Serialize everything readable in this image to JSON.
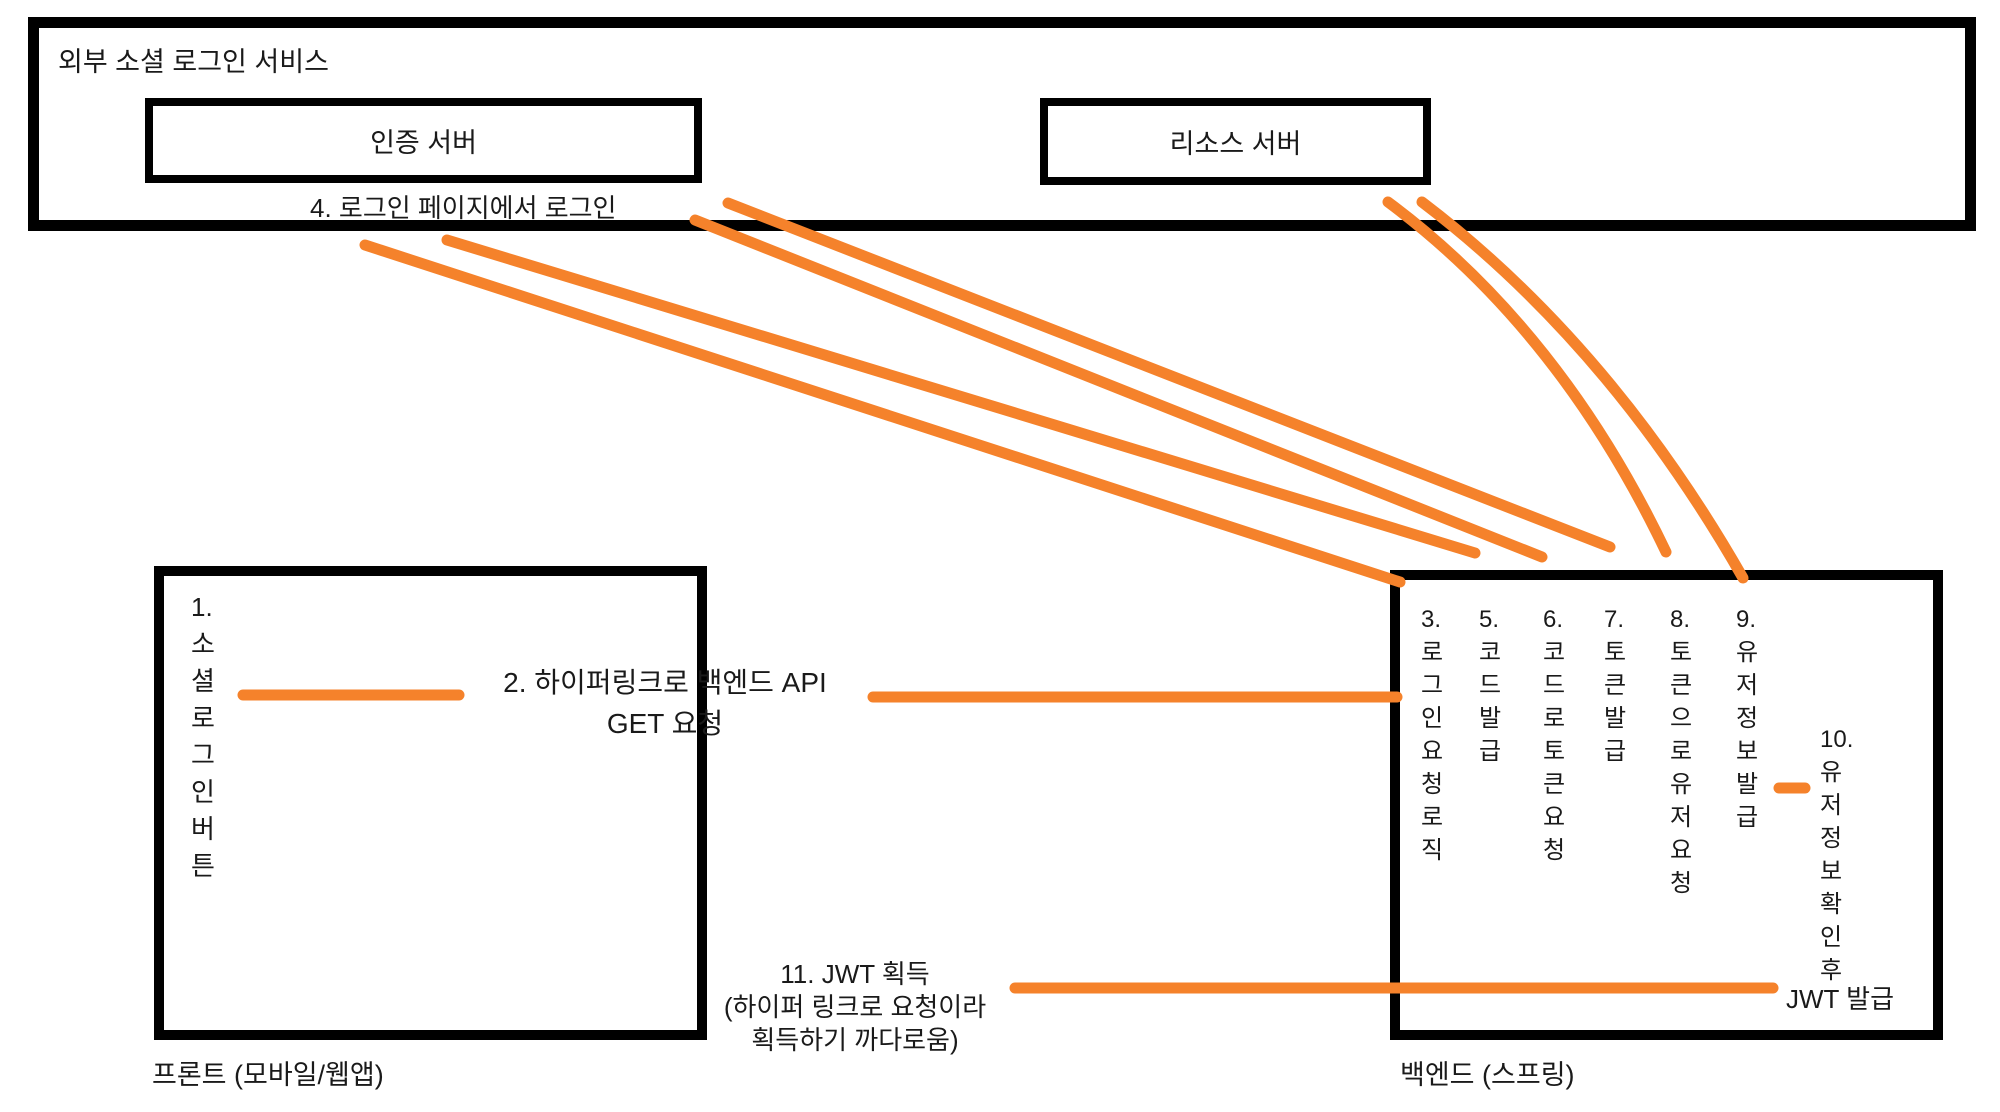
{
  "page": {
    "accent": "#f5822b",
    "stroke": "#000000",
    "background": "#ffffff"
  },
  "external_service": {
    "label": "외부 소셜 로그인 서비스",
    "auth_server_label": "인증 서버",
    "resource_server_label": "리소스 서버",
    "step4_label": "4. 로그인 페이지에서 로그인"
  },
  "frontend": {
    "social_login_button_text": "1.\n소\n셜\n로\n그\n인\n버\n튼",
    "step2_label": "2. 하이퍼링크로 백엔드 API\nGET 요청",
    "box_label": "프론트 (모바일/웹앱)"
  },
  "backend": {
    "columns": [
      "3.\n로\n그\n인\n요\n청\n로\n직",
      "5.\n코\n드\n발\n급",
      "6.\n코\n드\n로\n토\n큰\n요\n청",
      "7.\n토\n큰\n발\n급",
      "8.\n토\n큰\n으\n로\n유\n저\n요\n청",
      "9.\n유\n저\n정\n보\n발\n급"
    ],
    "step10_text": "10.\n유\n저\n정\n보\n확\n인\n후",
    "jwt_issue_label": "JWT 발급",
    "box_label": "백엔드 (스프링)"
  },
  "step11_label": "11. JWT 획득\n(하이퍼 링크로 요청이라\n획득하기 까다로움)",
  "connectors": [
    {
      "name": "button-to-step2-line",
      "x1": 243,
      "y1": 695,
      "x2": 459,
      "y2": 695
    },
    {
      "name": "step2-to-backend-line",
      "x1": 873,
      "y1": 697,
      "x2": 1397,
      "y2": 697
    },
    {
      "name": "login-request-to-auth-line",
      "x1": 365,
      "y1": 245,
      "x2": 1400,
      "y2": 582
    },
    {
      "name": "code-issue-to-backend-line",
      "x1": 447,
      "y1": 240,
      "x2": 1475,
      "y2": 553
    },
    {
      "name": "token-request-to-auth-line",
      "x1": 695,
      "y1": 220,
      "x2": 1542,
      "y2": 557
    },
    {
      "name": "token-issue-to-backend-line",
      "x1": 728,
      "y1": 203,
      "x2": 1610,
      "y2": 547
    },
    {
      "name": "user-request-to-resource-line",
      "x1": 1388,
      "y1": 202,
      "cx": 1560,
      "cy": 330,
      "x2": 1666,
      "y2": 552
    },
    {
      "name": "userinfo-issue-to-backend-line",
      "x1": 1422,
      "y1": 202,
      "cx": 1610,
      "cy": 345,
      "x2": 1743,
      "y2": 578
    },
    {
      "name": "step9-to-step10-dash",
      "x1": 1779,
      "y1": 788,
      "x2": 1805,
      "y2": 788
    },
    {
      "name": "jwt-to-frontend-line",
      "x1": 1015,
      "y1": 988,
      "x2": 1773,
      "y2": 988
    }
  ]
}
